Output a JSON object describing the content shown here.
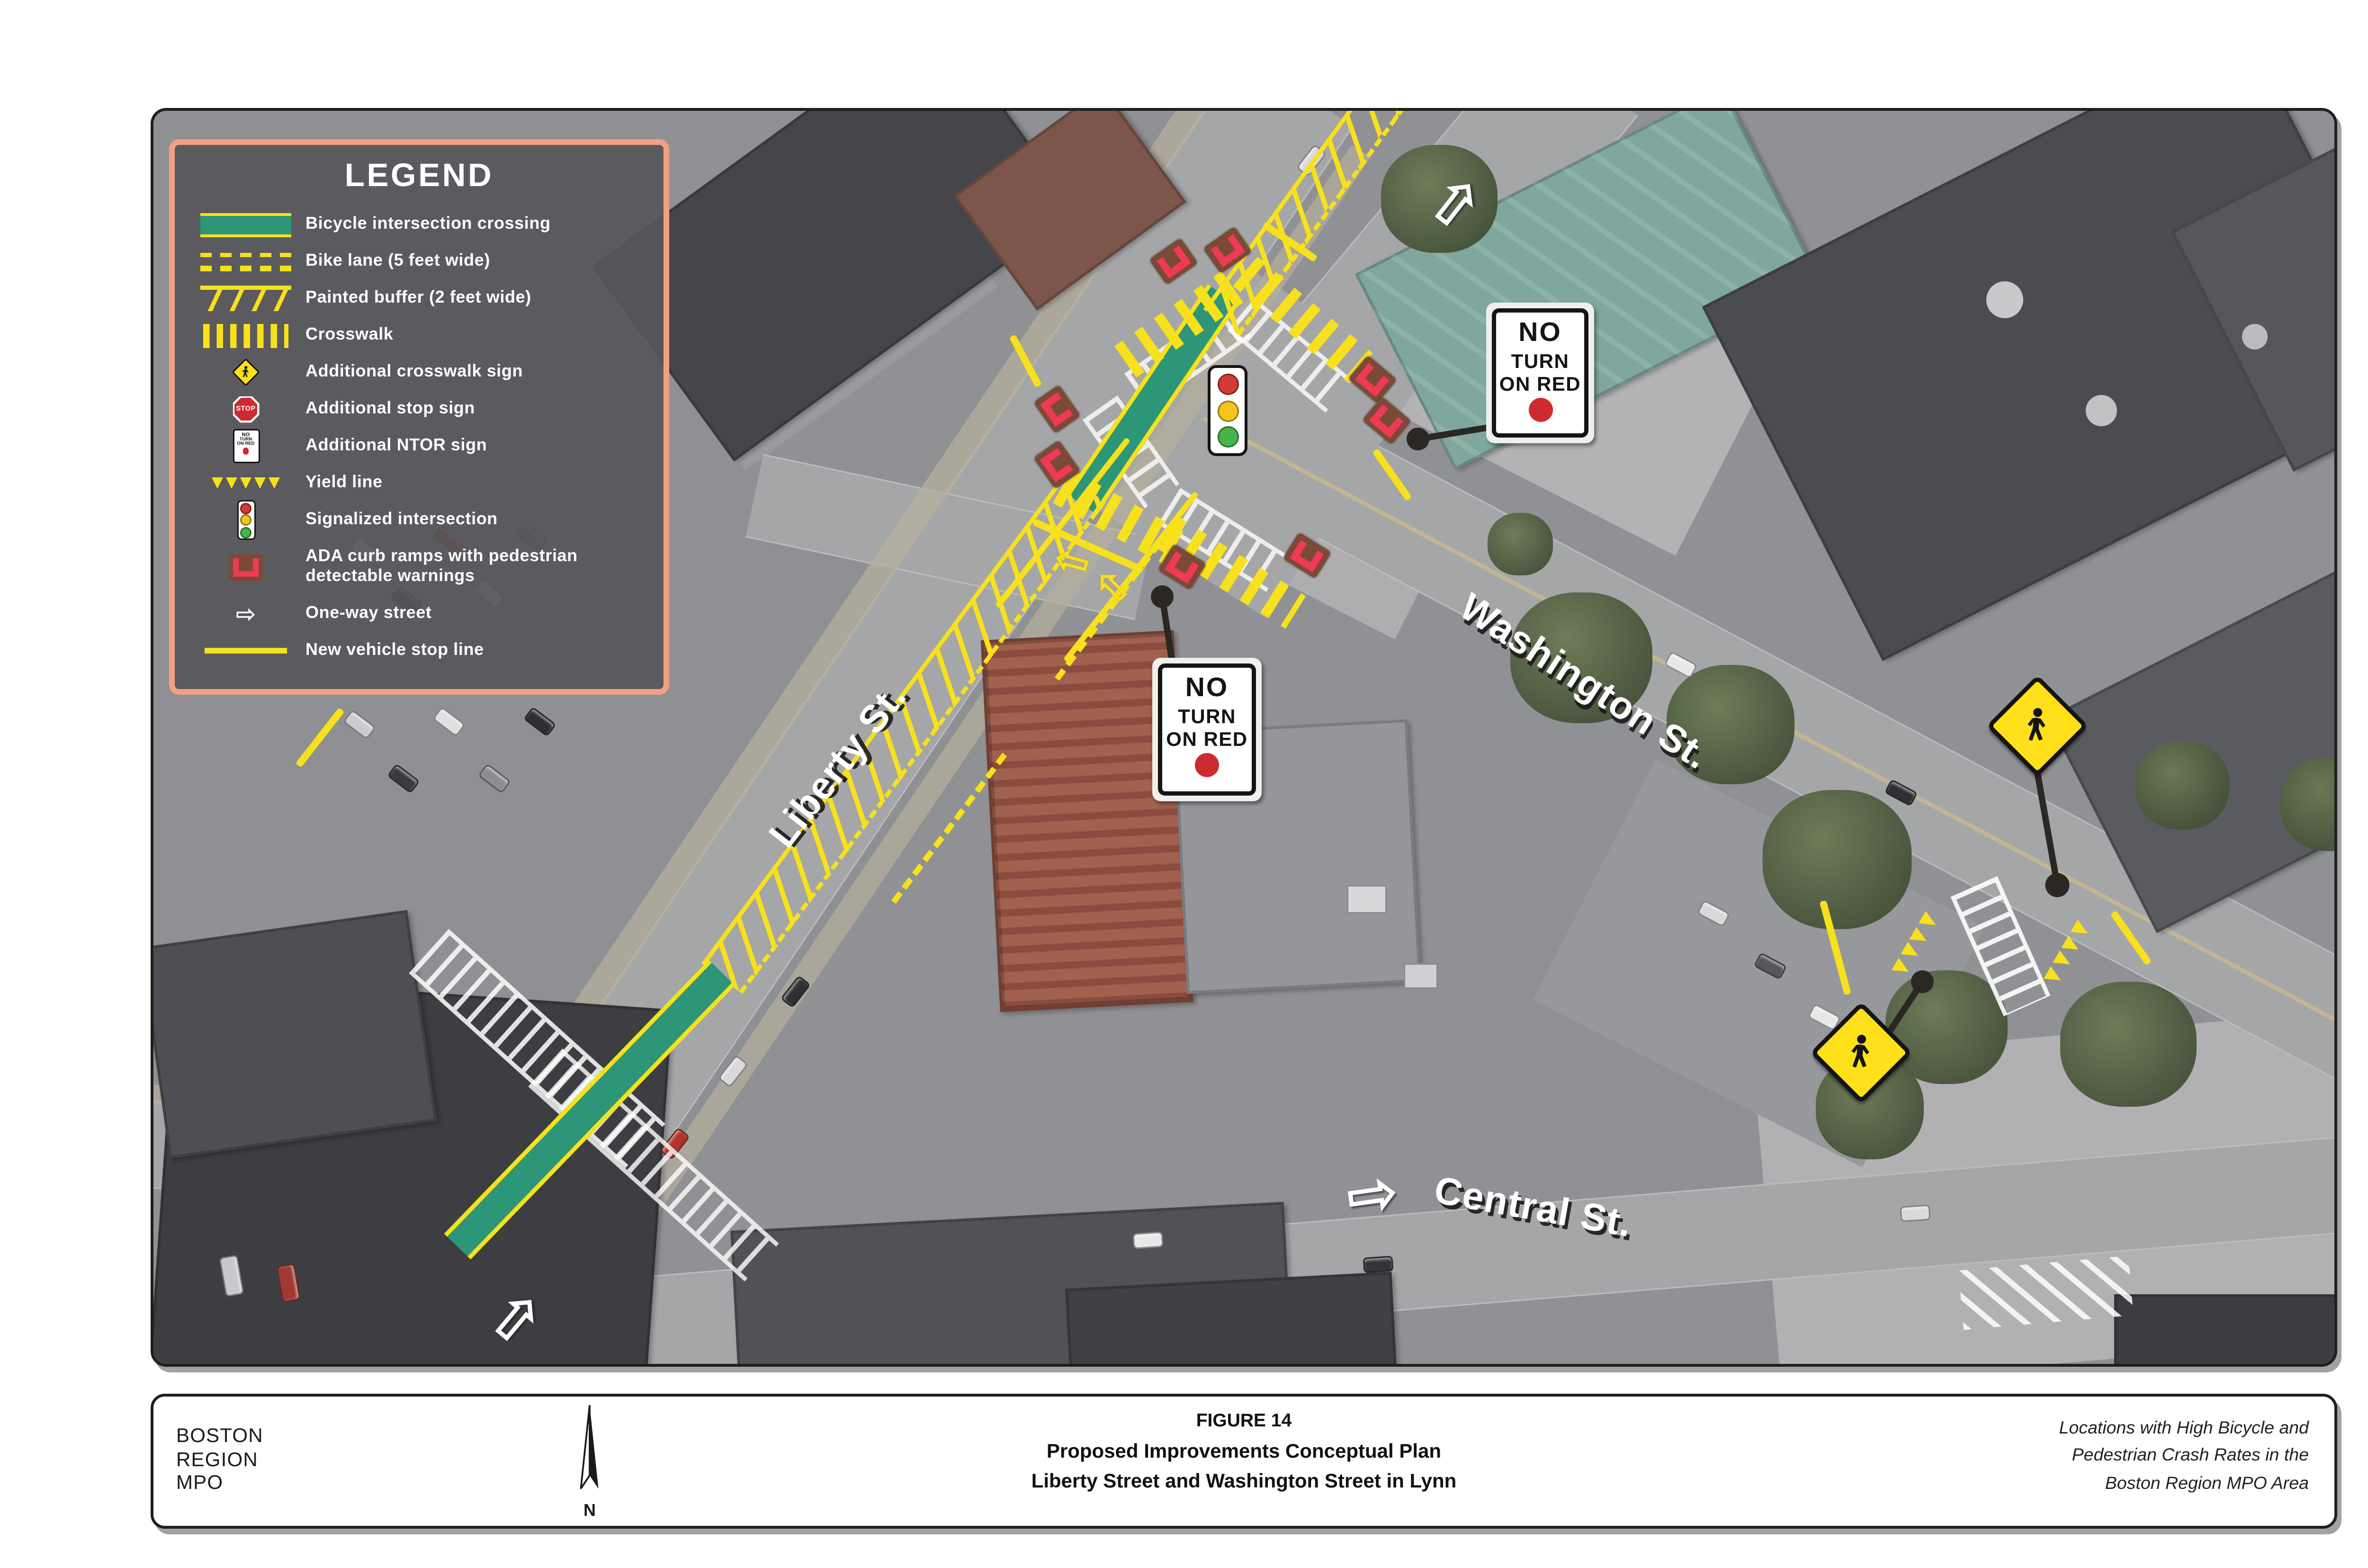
{
  "legend": {
    "title": "LEGEND",
    "items": [
      {
        "icon": "bicycle-crossing-swatch",
        "label": "Bicycle intersection crossing"
      },
      {
        "icon": "bike-lane-swatch",
        "label": "Bike lane (5 feet wide)"
      },
      {
        "icon": "painted-buffer-swatch",
        "label": "Painted buffer (2 feet wide)"
      },
      {
        "icon": "crosswalk-swatch",
        "label": "Crosswalk"
      },
      {
        "icon": "crosswalk-sign-icon",
        "label": "Additional crosswalk sign"
      },
      {
        "icon": "stop-sign-icon",
        "label": "Additional stop sign"
      },
      {
        "icon": "ntor-sign-icon",
        "label": "Additional NTOR sign"
      },
      {
        "icon": "yield-line-swatch",
        "label": "Yield line"
      },
      {
        "icon": "signal-icon",
        "label": "Signalized intersection"
      },
      {
        "icon": "ada-ramp-icon",
        "label": "ADA curb ramps with pedestrian\ndetectable warnings"
      },
      {
        "icon": "one-way-icon",
        "label": "One-way street"
      },
      {
        "icon": "stop-line-swatch",
        "label": "New vehicle stop line"
      }
    ]
  },
  "signs": {
    "ntor": {
      "line1": "NO",
      "line2": "TURN",
      "line3": "ON RED"
    },
    "stop": "STOP"
  },
  "streets": {
    "liberty": "Liberty St.",
    "washington": "Washington St.",
    "central": "Central St."
  },
  "footer": {
    "org": "BOSTON\nREGION\nMPO",
    "north": "N",
    "figure": "FIGURE 14",
    "title1": "Proposed  Improvements Conceptual Plan",
    "title2": "Liberty Street and Washington Street in Lynn",
    "note": "Locations with High Bicycle and\nPedestrian Crash Rates in the\nBoston Region MPO Area"
  },
  "colors": {
    "overlay_yellow": "#f7e11c",
    "bike_green": "#2d9678",
    "ada_red": "#ee3a55",
    "ada_brown": "#7b4a36",
    "legend_border": "#f2a083",
    "sign_red": "#ce2b30",
    "signal_red": "#d23b33",
    "signal_amber": "#f2c41d",
    "signal_green": "#46b449",
    "ped_sign_yellow": "#ffe01a"
  }
}
